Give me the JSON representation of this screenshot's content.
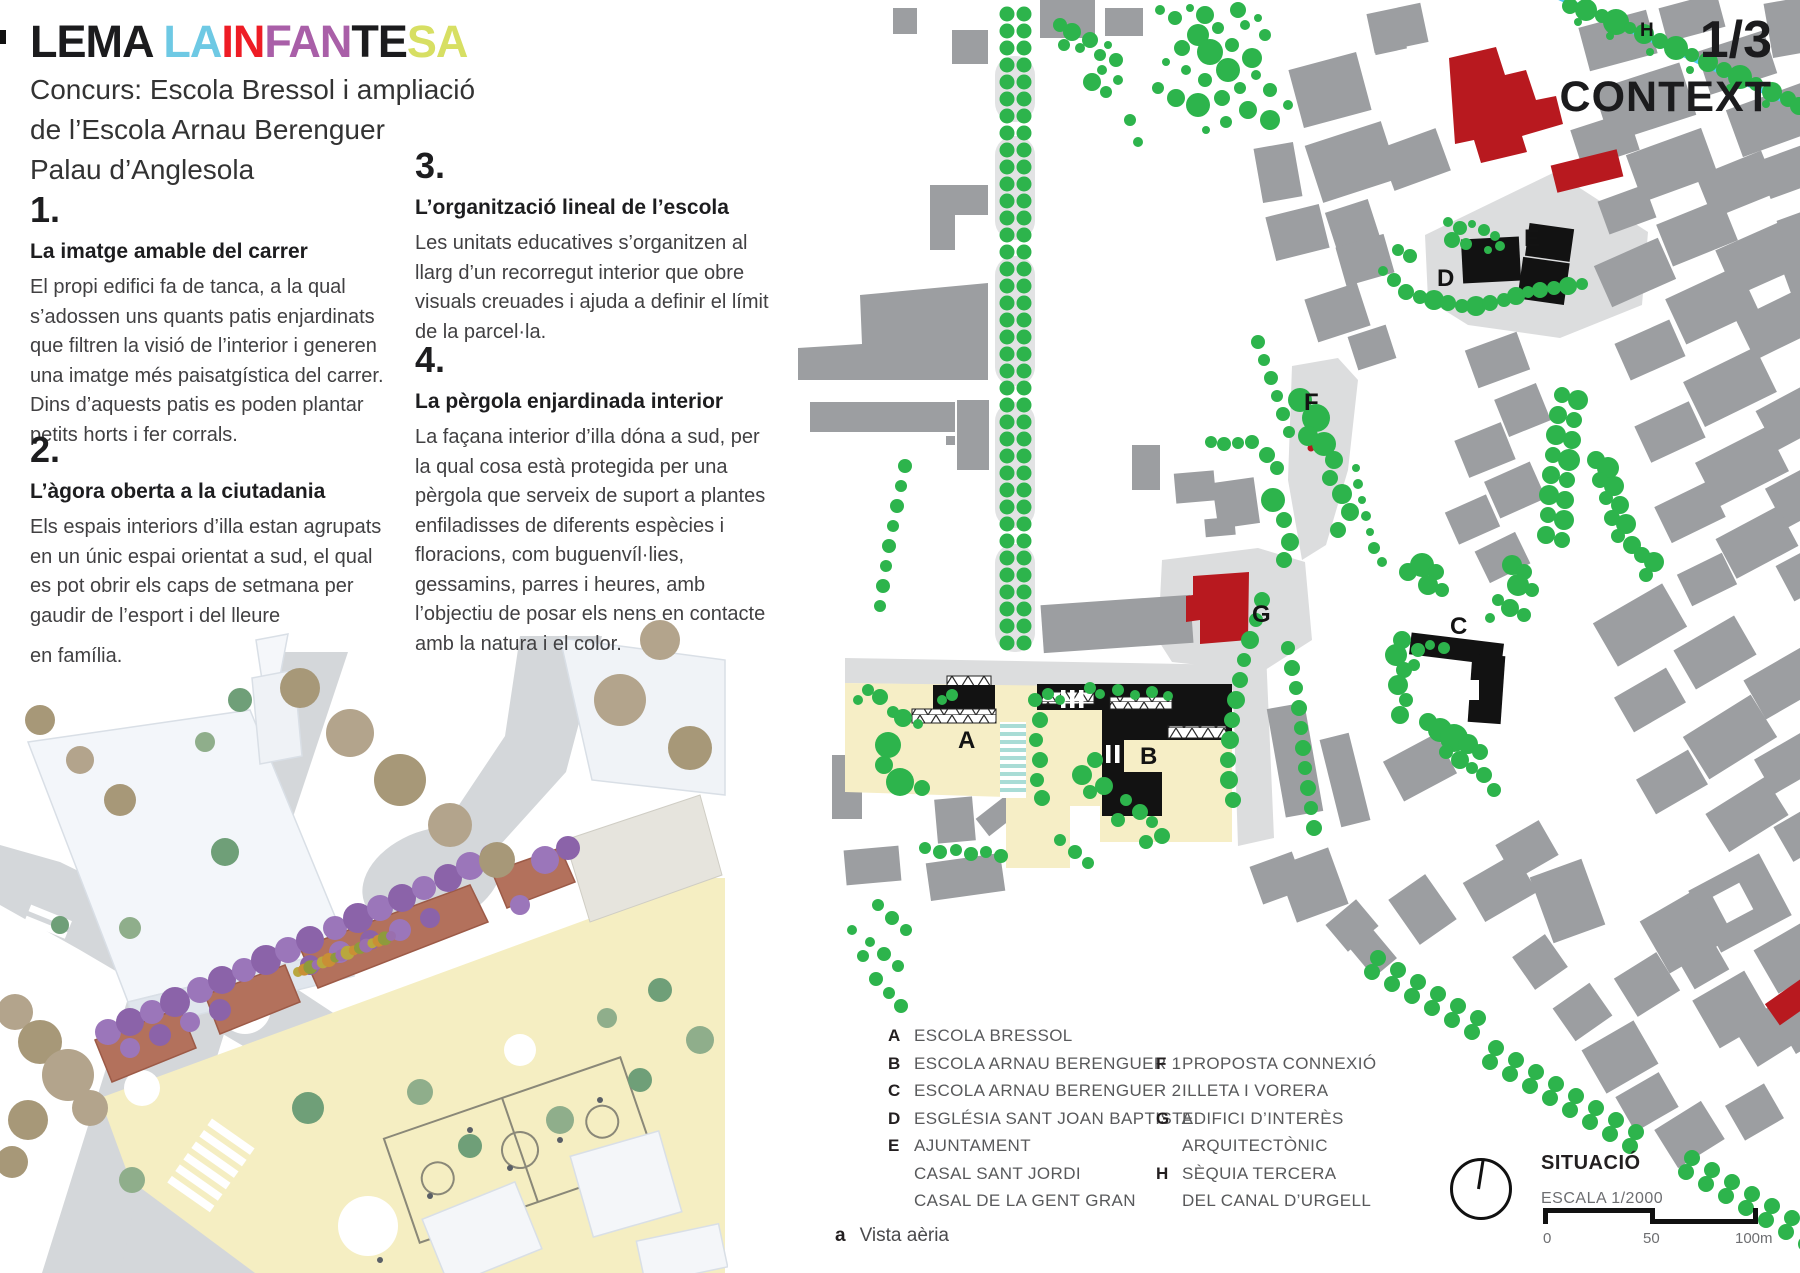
{
  "title": {
    "segments": [
      {
        "text": "LEMA ",
        "color": "#1b1b1d"
      },
      {
        "text": "LA",
        "color": "#6ec9e4"
      },
      {
        "text": "IN",
        "color": "#ee1c25"
      },
      {
        "text": "FAN",
        "color": "#a95fa8"
      },
      {
        "text": "TE",
        "color": "#1b1b1d"
      },
      {
        "text": "SA",
        "color": "#d7df63"
      }
    ],
    "subtitle": "Concurs: Escola Bressol i ampliació\nde l’Escola Arnau Berenguer\nPalau d’Anglesola"
  },
  "page_header": {
    "page_num": "1/3",
    "page_title": "CONTEXT"
  },
  "sections": [
    {
      "num": "1.",
      "heading": "La imatge amable del carrer",
      "body": "El propi edifici fa de tanca, a la qual\ns’adossen uns quants patis enjardinats\nque filtren la visió de l’interior i generen\nuna imatge més paisatgística del carrer.\nDins d’aquests patis es poden plantar\npetits horts i fer corrals."
    },
    {
      "num": "2.",
      "heading": "L’àgora oberta a la ciutadania",
      "body": "Els espais interiors d’illa estan agrupats\nen un únic espai orientat a sud, el qual\nes pot obrir els caps de setmana per\ngaudir de l’esport i del lleure",
      "extra": "en família."
    },
    {
      "num": "3.",
      "heading": "L’organització lineal de l’escola",
      "body": "Les unitats educatives s’organitzen al\nllarg d’un recorregut interior que obre\nvisuals creuades i ajuda a definir el límit\nde la parcel·la."
    },
    {
      "num": "4.",
      "heading": "La pèrgola enjardinada interior",
      "body": "La façana interior d’illa dóna a sud, per\nla qual cosa està protegida per una\npèrgola que serveix de suport a plantes\nenfiladisses de diferents espècies i\nfloracions, com buguenvíl·lies,\ngessamins, parres i heures, amb\nl’objectiu de posar els nens en contacte\namb la natura i el color."
    }
  ],
  "map_labels": [
    "A",
    "B",
    "C",
    "D",
    "E",
    "F",
    "G",
    "H"
  ],
  "legend": {
    "col1": [
      {
        "letter": "A",
        "label": "ESCOLA BRESSOL"
      },
      {
        "letter": "B",
        "label": "ESCOLA ARNAU BERENGUER 1"
      },
      {
        "letter": "C",
        "label": "ESCOLA ARNAU BERENGUER 2"
      },
      {
        "letter": "D",
        "label": "ESGLÉSIA SANT JOAN BAPTISTA"
      },
      {
        "letter": "E",
        "label": "AJUNTAMENT"
      },
      {
        "letter": "",
        "label": "CASAL SANT JORDI"
      },
      {
        "letter": "",
        "label": "CASAL DE LA GENT GRAN"
      }
    ],
    "col2": [
      {
        "letter": "F",
        "label": "PROPOSTA CONNEXIÓ"
      },
      {
        "letter": "",
        "label": "ILLETA I VORERA"
      },
      {
        "letter": "G",
        "label": "EDIFICI D’INTERÈS"
      },
      {
        "letter": "",
        "label": "ARQUITECTÒNIC"
      },
      {
        "letter": "H",
        "label": "SÈQUIA TERCERA"
      },
      {
        "letter": "",
        "label": "DEL CANAL D’URGELL"
      }
    ],
    "note": {
      "letter": "a",
      "label": "Vista aèria"
    }
  },
  "situacio": {
    "title": "SITUACIÓ",
    "scale_label": "ESCALA 1/2000",
    "ticks": [
      "0",
      "50",
      "100m"
    ]
  },
  "colors": {
    "tree_green": "#2db44c",
    "building_gray": "#9c9ea1",
    "plaza_gray": "#dcddde",
    "key_red": "#b8191f",
    "key_black": "#121212",
    "canal_cyan": "#4ec9f0",
    "school_cream": "#f6eec6",
    "crosswalk_aqua": "#a9dcd6"
  }
}
